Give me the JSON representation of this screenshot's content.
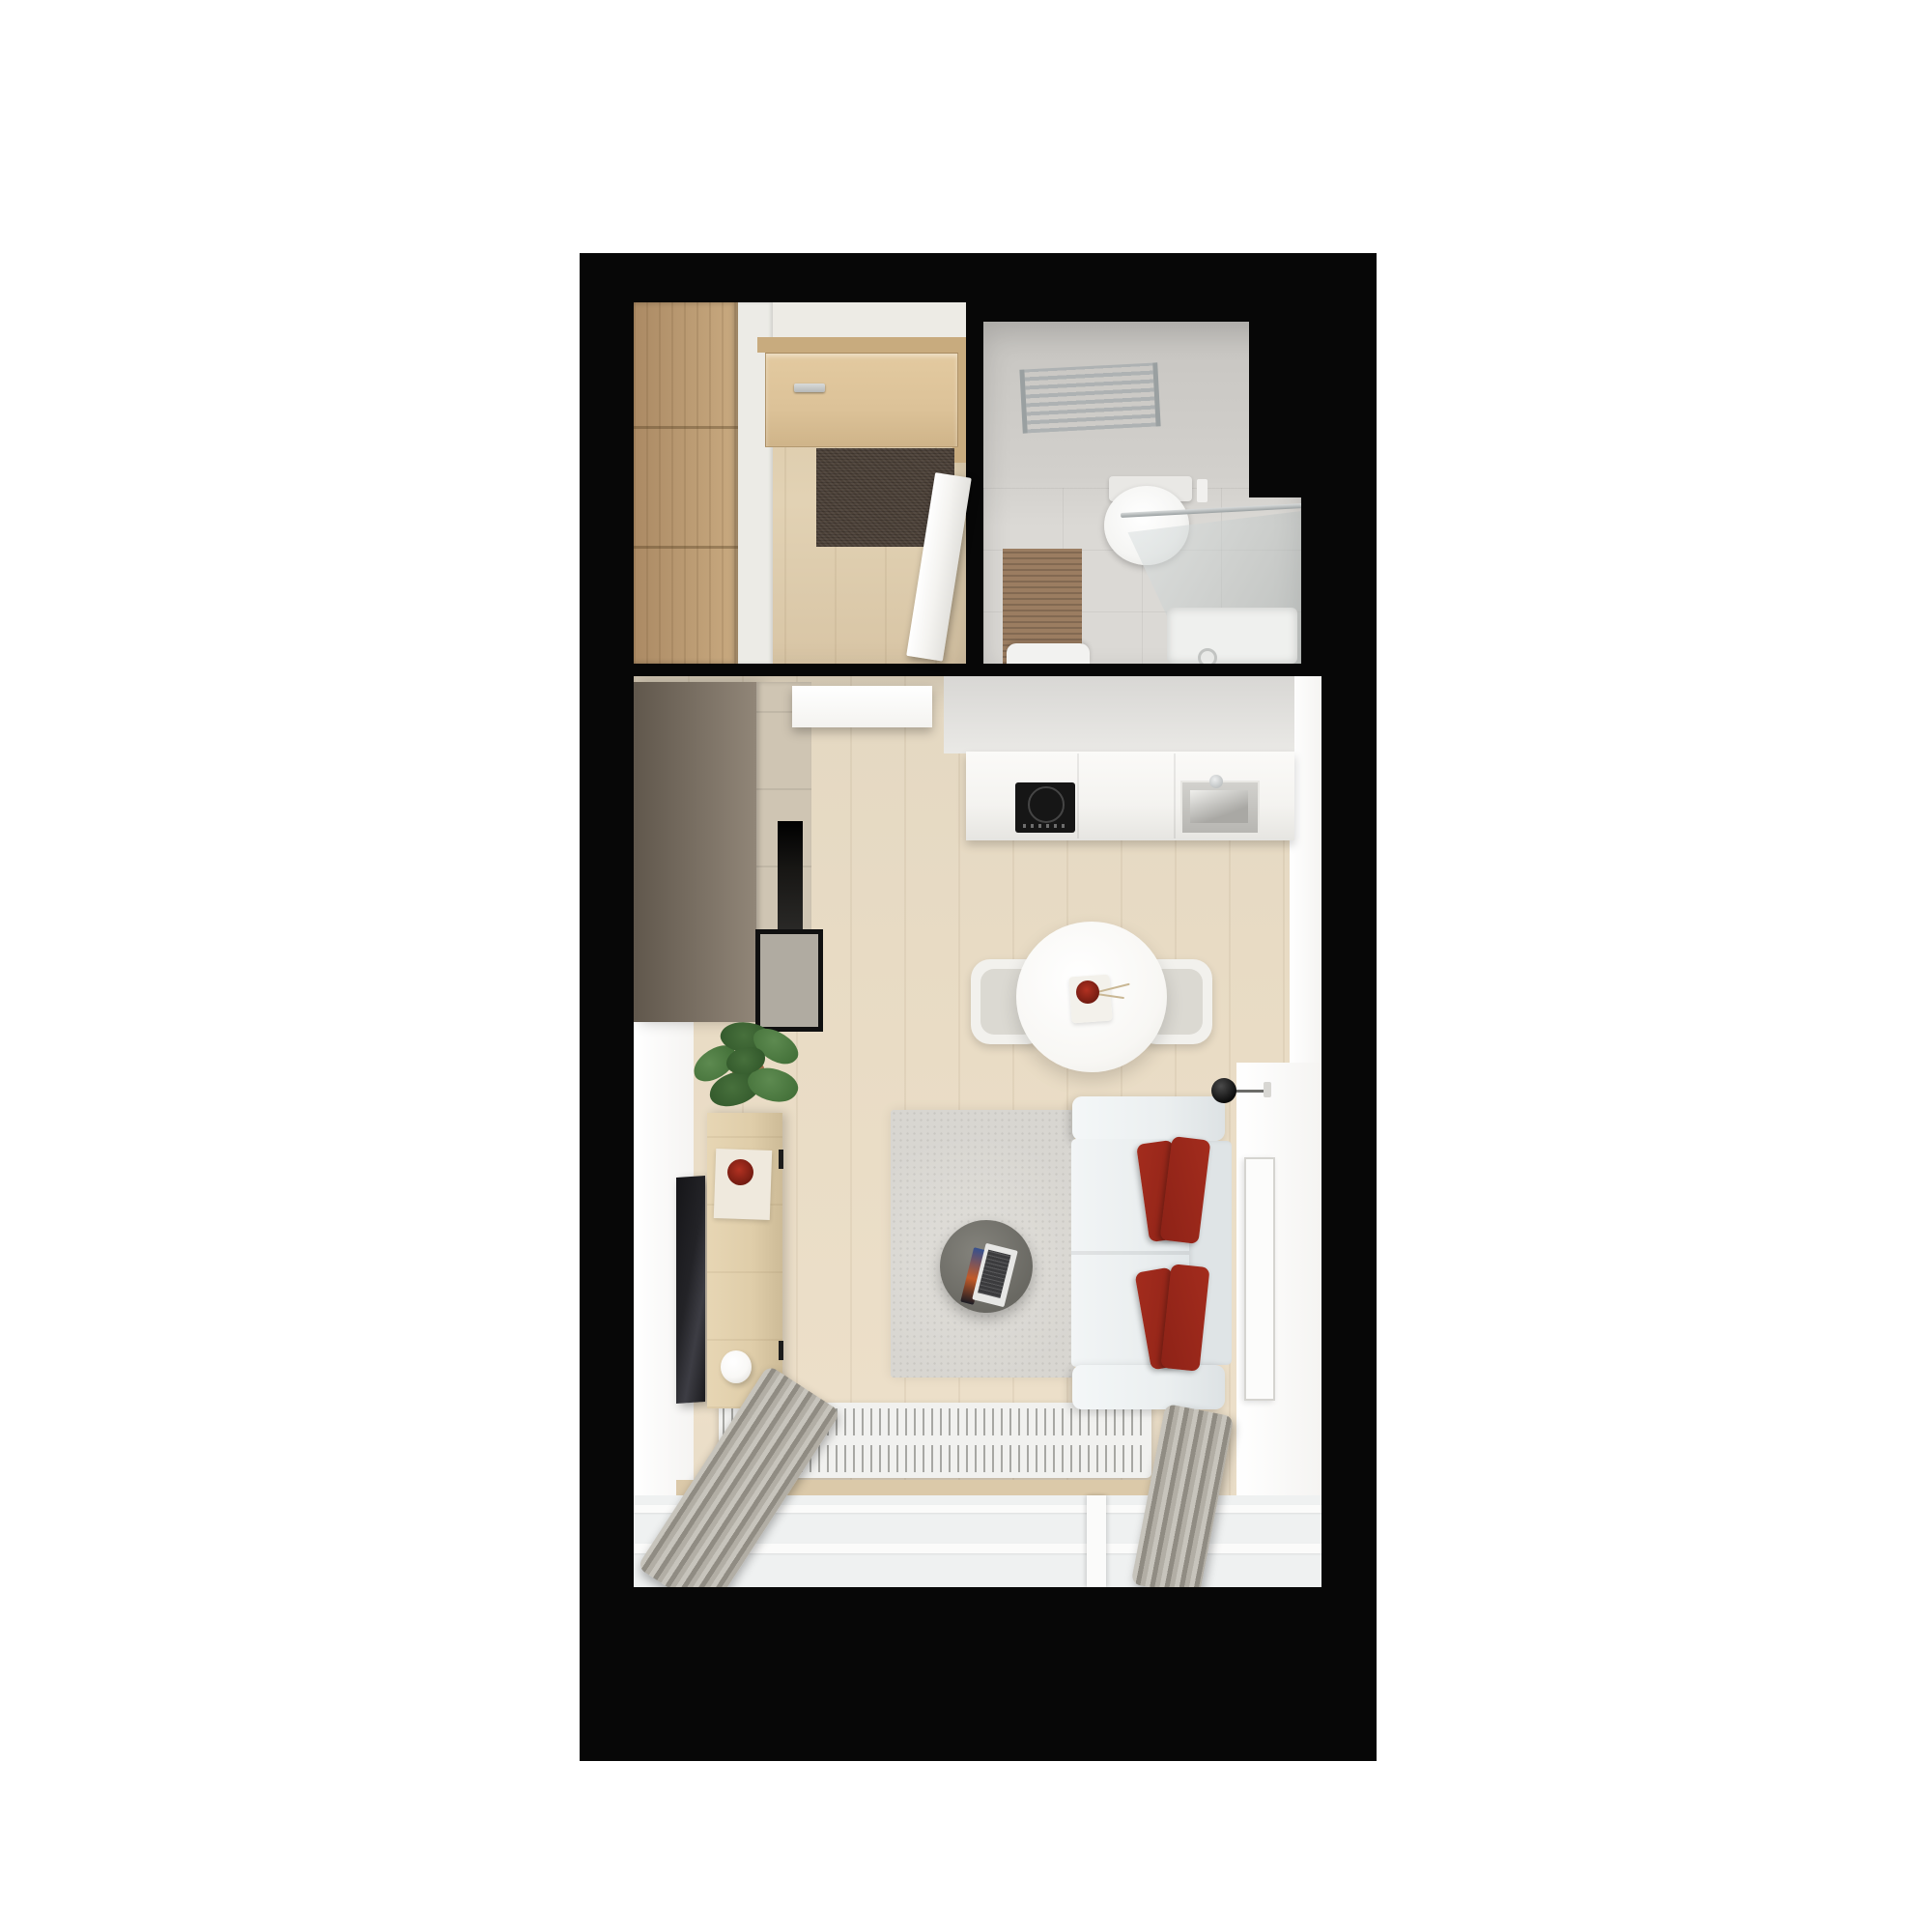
{
  "scene": {
    "title": "Top-down 3D render of a studio apartment floor plan",
    "style": "photorealistic architectural visualization, white page background, black wall mass",
    "rooms": [
      {
        "id": "hallway",
        "name": "Entrance hall",
        "items": [
          "wardrobe",
          "wardrobe-side-panel",
          "entrance-door",
          "door-handle",
          "doormat",
          "open-white-door",
          "wood-floor"
        ]
      },
      {
        "id": "bathroom",
        "name": "Bathroom",
        "items": [
          "towel-radiator",
          "toilet",
          "flush-plate",
          "bath-mat",
          "shower-glass-enclosure",
          "shower-tray",
          "drain",
          "washbasin",
          "gray-tile-floor"
        ]
      },
      {
        "id": "living-room",
        "name": "Living room with kitchenette",
        "items": [
          "tall-kitchen-units",
          "built-in-oven",
          "appliance-panel",
          "open-door-leaf",
          "backsplash",
          "kitchen-counter",
          "induction-cooktop",
          "kitchen-sink",
          "faucet",
          "round-dining-table",
          "dining-chair-left",
          "dining-chair-right",
          "decor-tray",
          "red-vase-with-sprigs",
          "area-rug",
          "two-seat-sofa",
          "red-cushions",
          "round-coffee-table",
          "open-laptop",
          "wall-lamp",
          "wall-mounted-tv",
          "wooden-sideboard",
          "book-with-red-bowl",
          "white-jug",
          "potted-plant",
          "panel-radiator",
          "window-sill",
          "window",
          "curtain-left",
          "curtain-right",
          "picture-frame"
        ]
      }
    ]
  },
  "colors": {
    "page-bg": "#ffffff",
    "wall-black": "#070707",
    "hall-floor": "#d8c5a5",
    "wardrobe-wood-1": "#c9aa80",
    "wardrobe-wood-2": "#ab8a64",
    "wardrobe-side": "#ecebe6",
    "door-wood": "#dcc298",
    "door-lintel": "#c8ab7e",
    "door-handle": "#b6b8b7",
    "doormat": "#4c4138",
    "white-door": "#f4f3f0",
    "bath-wall": "#c7c5c1",
    "bath-floor": "#dbd9d5",
    "chrome": "#aeb2b3",
    "toilet-white": "#f5f5f3",
    "bathmat": "#9b7d61",
    "glass-tint": "rgba(185,192,192,0.45)",
    "shower-tray": "#eff0ee",
    "living-floor": "#e9dcc5",
    "wall-white": "#f5f4f2",
    "kitchen-dark-1": "#60574c",
    "kitchen-dark-2": "#918678",
    "cabinet-beige": "#cfc5b3",
    "oven-black": "#171614",
    "panel-gray": "#b0aba1",
    "counter-white": "#f4f3f0",
    "backsplash-1": "#d8d7d4",
    "backsplash-2": "#eae9e6",
    "cooktop-black": "#161616",
    "sink-steel-1": "#d2d1cd",
    "sink-steel-2": "#b7b6b2",
    "table-white": "#f8f7f4",
    "chair-white": "#f2f1ed",
    "chair-cushion": "#dbd9d2",
    "rug-gray": "#d8d6d1",
    "sofa-light": "#ebeff0",
    "sofa-back": "#dfe4e6",
    "pillow-red-1": "#8d2217",
    "pillow-red-2": "#a32c1d",
    "coffee-table-1": "#84837c",
    "coffee-table-2": "#696862",
    "laptop-silver": "#e7e7e5",
    "keyboard-dark": "#3b3b3d",
    "screen-blue": "#35508f",
    "tv-dark": "#232327",
    "sideboard-wood": "#dfcda9",
    "book-cream": "#efe9dd",
    "bowl-red": "#b23121",
    "jug-white": "#f9f8f6",
    "plant-green": "#3e6b34",
    "plant-green-dark": "#2d5327",
    "pot-terracotta": "#9a6946",
    "radiator-white": "#f1f1ef",
    "fin-gray": "#a7a7a3",
    "sill-wood": "#dbc9a9",
    "window-gray": "#eff1f1",
    "window-white": "#fbfbfa",
    "curtain-1": "#c7c4bc",
    "curtain-2": "#908c83",
    "curtain-3": "#b2aea5"
  }
}
